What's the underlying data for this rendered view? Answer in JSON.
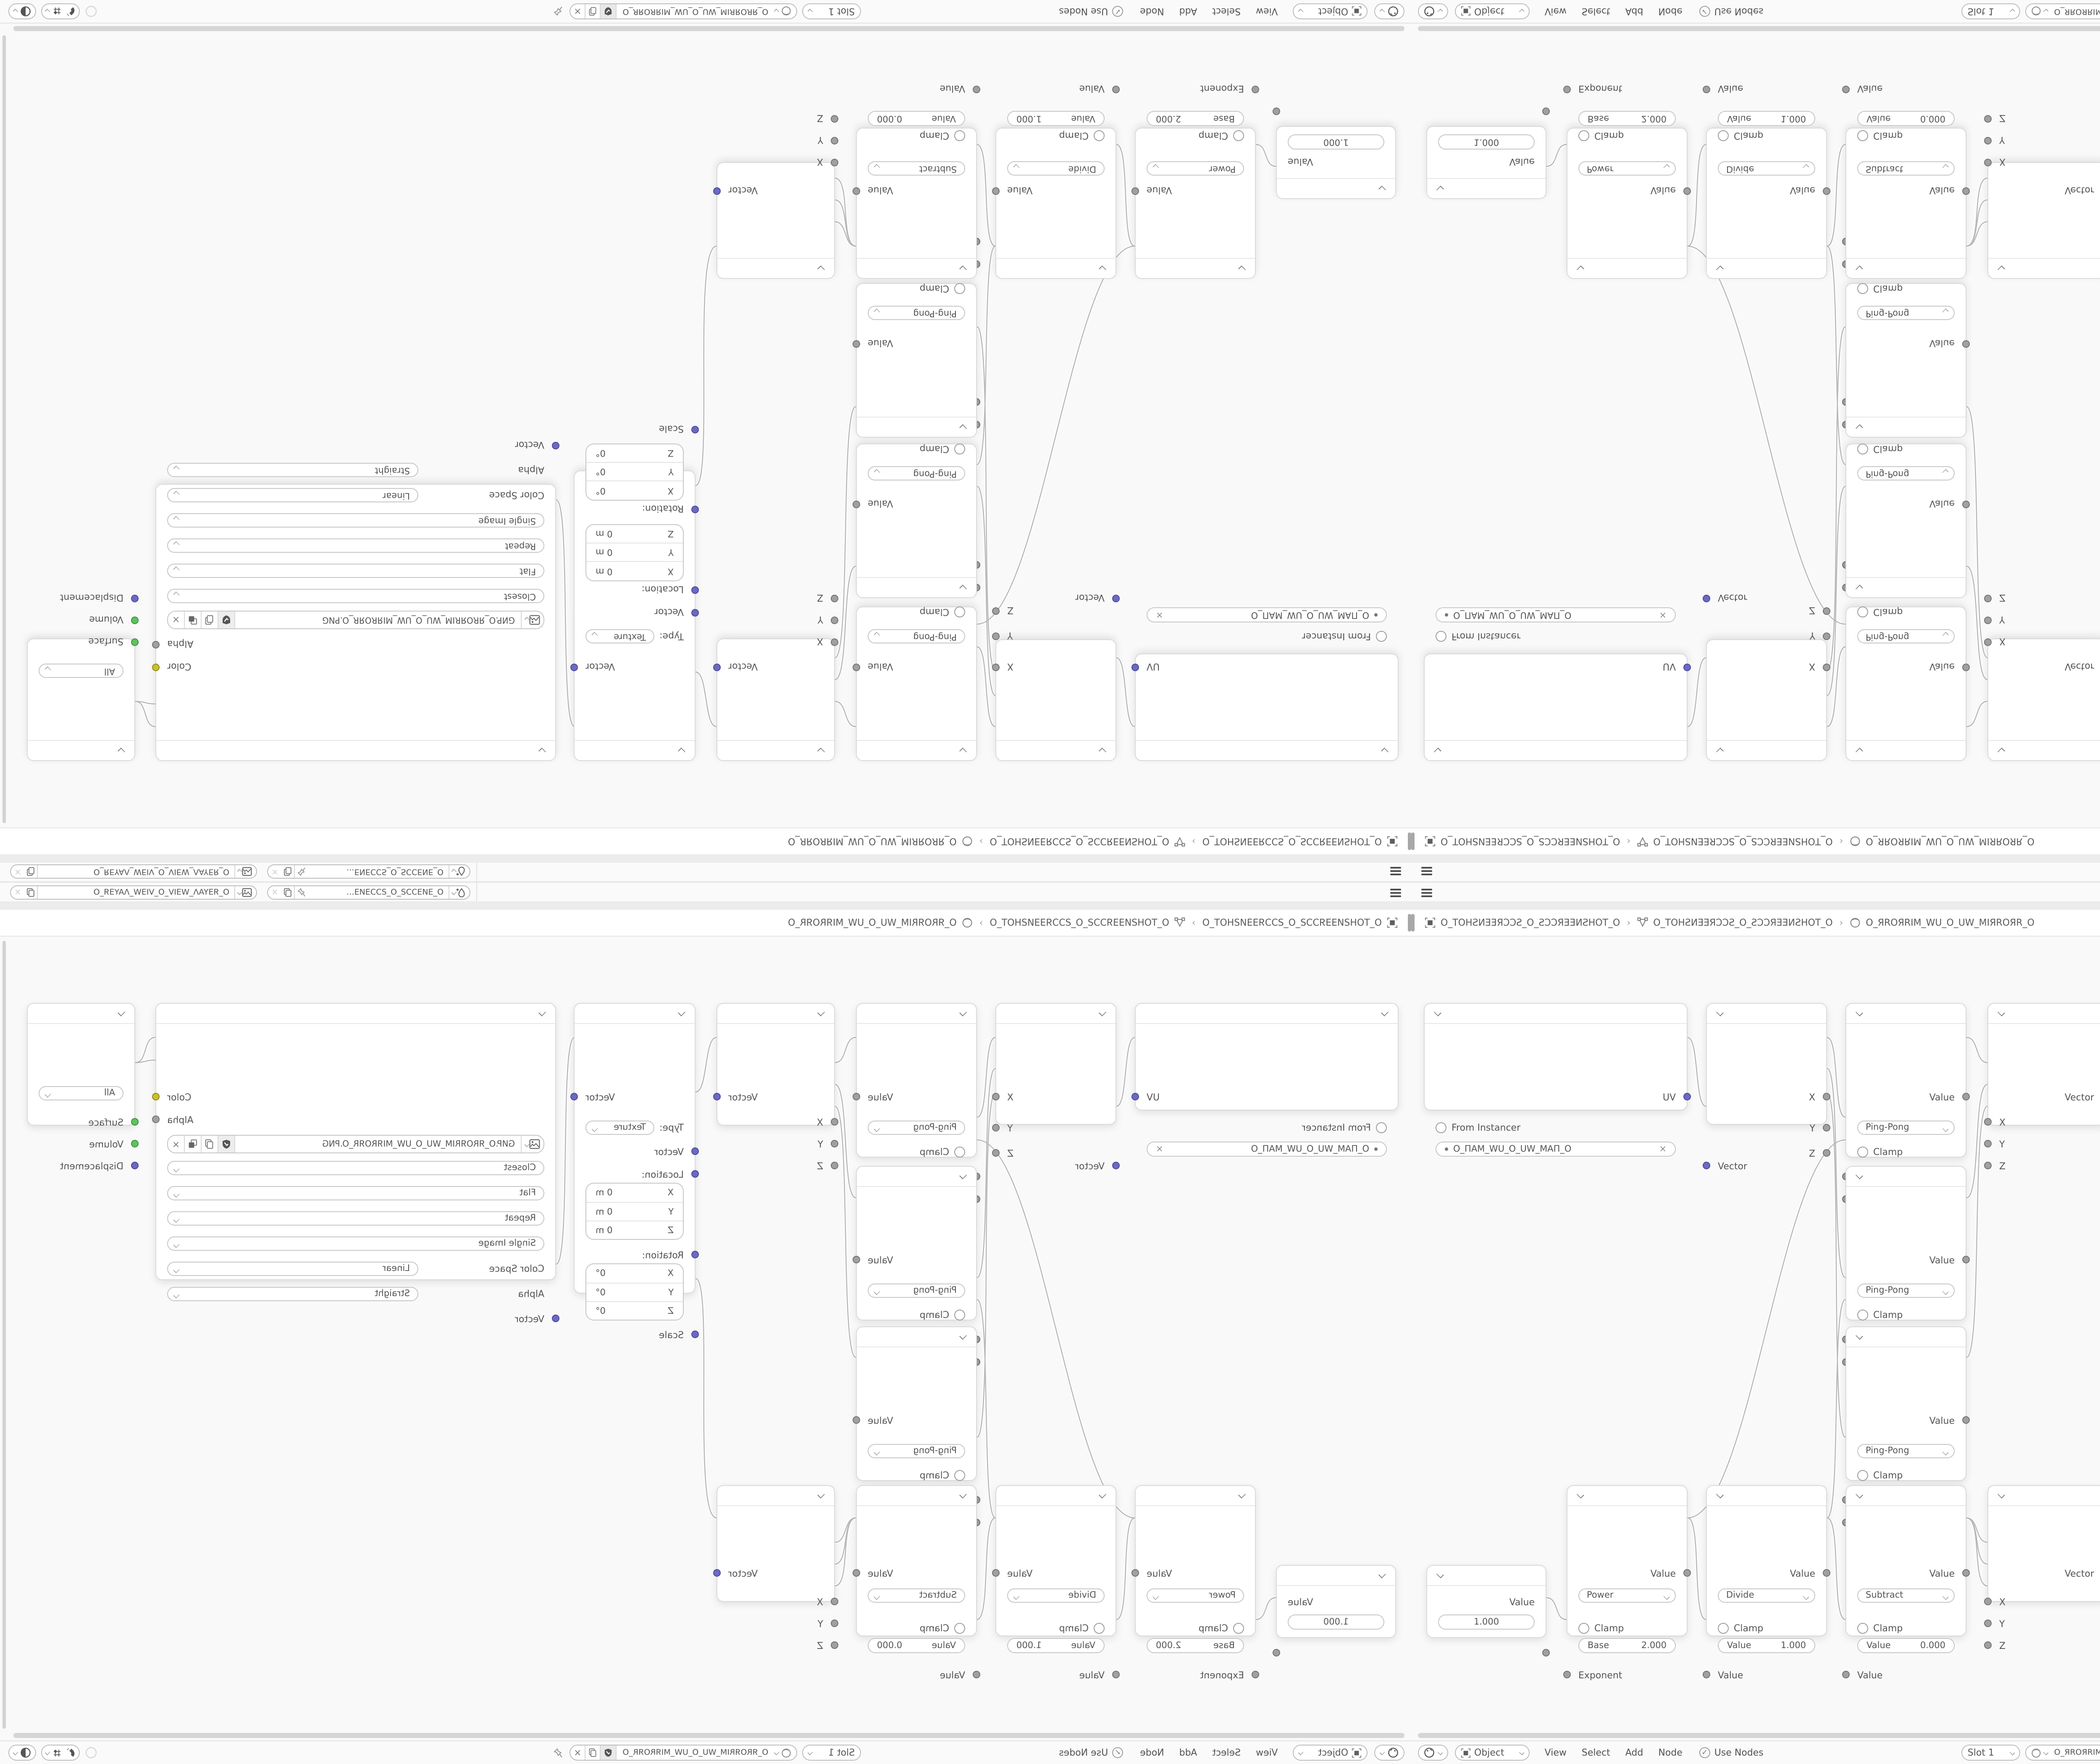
{
  "app": "Blender shader node editor (4-way mirrored screenshot)",
  "theme": {
    "socket_vector": "#6b69c8",
    "socket_value": "#a0a0a0",
    "socket_color": "#c9c12c",
    "socket_shader": "#5cc45c",
    "wire": "#b9b9b9",
    "node_bg": "#ffffff",
    "editor_bg": "#f9f9f9"
  },
  "topbar": {
    "scene_selector": {
      "value": "O_ƎИƎƆƆƧ_O_ƧƆƆƎИƎ…"
    },
    "viewlayer_selector": {
      "value": "O_ЯƎYAΛ_WƎIV_O_VIƎW_ΛAYƎЯ_O"
    },
    "close_label": "×"
  },
  "breadcrumb": {
    "items": [
      {
        "label": "O_TOHƧИƎƎЯƆƆƧ_O_ƧƆƆЯƎƎИƧHOT_O"
      },
      {
        "label": "O_TOHƧИƎƎЯƆƆƧ_O_ƧƆƆЯƎƎИƧHOT_O"
      },
      {
        "label": "O_ЯROЯRIM_WU_O_UW_MIЯROЯR_O"
      }
    ],
    "separator": "›"
  },
  "nodes": {
    "uv_map": {
      "output": "UV",
      "from_instancer": "From Instancer",
      "uv_name": "O_ПAM_WU_O_UW_MAП_O",
      "clear_label": "×"
    },
    "separate_xyz": {
      "outputs": [
        "X",
        "Y",
        "Z"
      ],
      "input": "Vector"
    },
    "math_pingpong": {
      "output": "Value",
      "operation": "Ping-Pong",
      "clamp": "Clamp",
      "input_value": "Value",
      "input_scale": "Scale"
    },
    "combine_xyz": {
      "output": "Vector",
      "inputs": [
        "X",
        "Y",
        "Z"
      ]
    },
    "mapping": {
      "output": "Vector",
      "type_label": "Type:",
      "type_value": "Texture",
      "input_vector": "Vector",
      "location_label": "Location:",
      "location_rows": [
        {
          "k": "X",
          "v": "0 m"
        },
        {
          "k": "Y",
          "v": "0 m"
        },
        {
          "k": "Z",
          "v": "0 m"
        }
      ],
      "rotation_label": "Rotation:",
      "rotation_rows": [
        {
          "k": "X",
          "v": "0°"
        },
        {
          "k": "Y",
          "v": "0°"
        },
        {
          "k": "Z",
          "v": "0°"
        }
      ],
      "scale_label": "Scale"
    },
    "image_texture": {
      "output_color": "Color",
      "output_alpha": "Alpha",
      "filename": "GИP.O_ЯROЯRIM_WU_O_UW_MIЯROЯR_O.PNG",
      "interpolation": "Closest",
      "projection": "Flat",
      "extension": "Repeat",
      "source": "Single Image",
      "color_space_label": "Color Space",
      "color_space_value": "Linear",
      "alpha_label": "Alpha",
      "alpha_value": "Straight",
      "input": "Vector",
      "close_label": "×"
    },
    "material_output": {
      "target": "All",
      "inputs": [
        "Surface",
        "Volume",
        "Displacement"
      ]
    },
    "value": {
      "output": "Value",
      "value": "1.000"
    },
    "math_power": {
      "output": "Value",
      "operation": "Power",
      "clamp": "Clamp",
      "field_label": "Base",
      "field_value": "2.000",
      "input": "Exponent"
    },
    "math_divide": {
      "output": "Value",
      "operation": "Divide",
      "clamp": "Clamp",
      "field_label": "Value",
      "field_value": "1.000",
      "input": "Value"
    },
    "math_subtract": {
      "output": "Value",
      "operation": "Subtract",
      "clamp": "Clamp",
      "field_label": "Value",
      "field_value": "0.000",
      "input": "Value"
    }
  },
  "header": {
    "mode": "Object",
    "menus": [
      {
        "label": "View"
      },
      {
        "label": "Select"
      },
      {
        "label": "Add"
      },
      {
        "label": "Node"
      }
    ],
    "use_nodes": "Use Nodes",
    "slot": "Slot 1",
    "material_name": "O_ЯROЯRIM_WU_O_UW_MIЯROЯR_O",
    "close_label": "×"
  }
}
